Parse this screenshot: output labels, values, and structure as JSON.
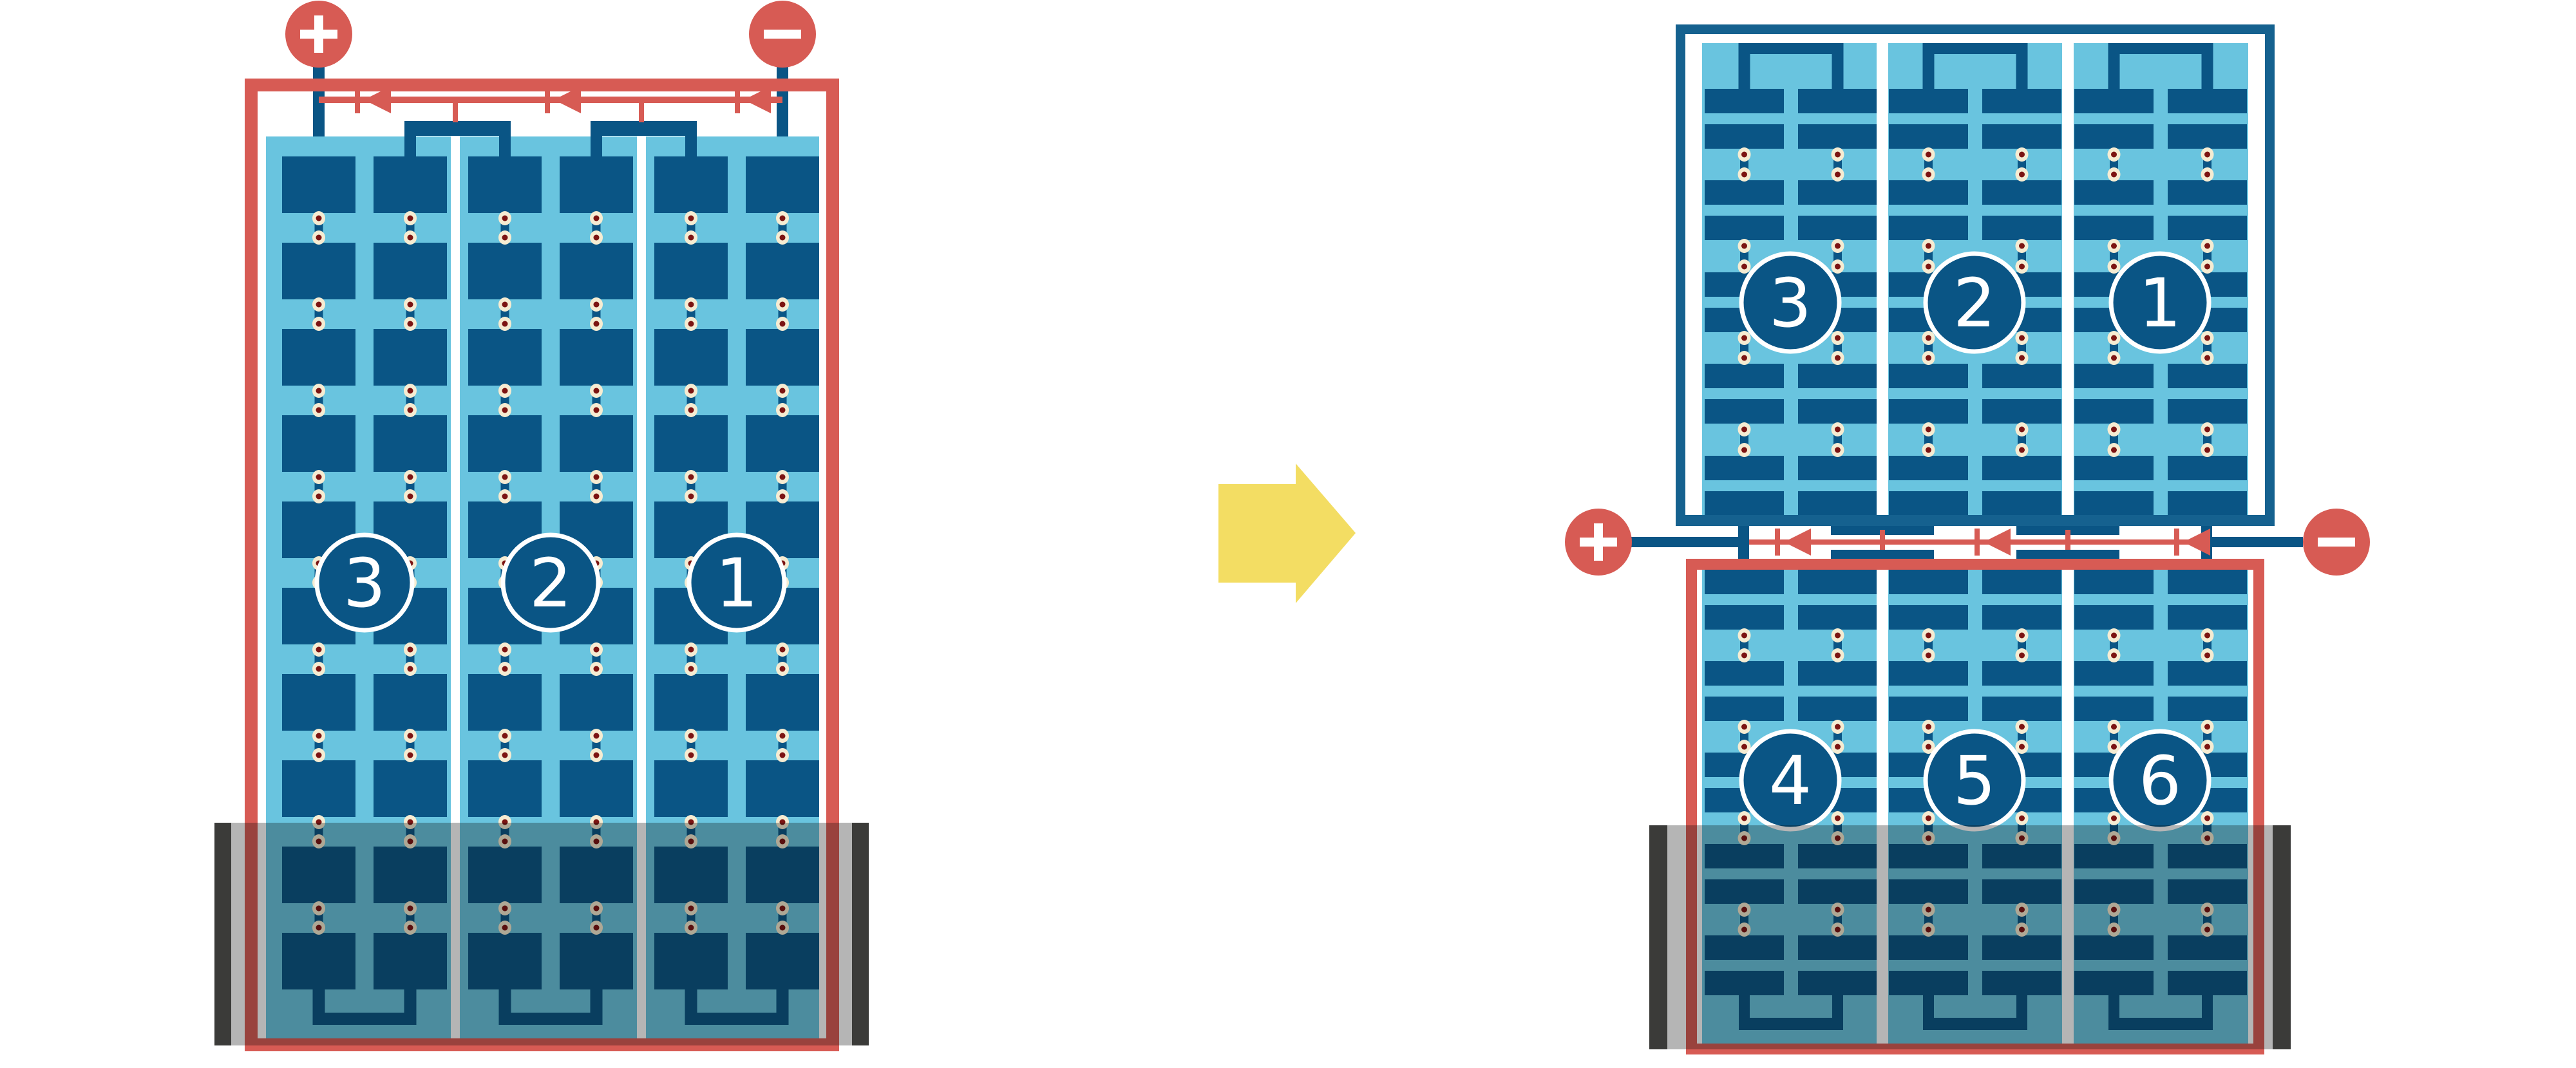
{
  "colors": {
    "red": "#d75b54",
    "module_blue": "#0a5585",
    "frame_blue": "#15618f",
    "panel_light_blue": "#69c4df",
    "cream": "#f6ecd2",
    "dot_core_red": "#7c1412",
    "shade_bar_black": "#3b3b39",
    "shade_overlay": "rgba(10,10,10,0.30)",
    "arrow_yellow": "#f3dd63",
    "badge_text": "#ffffff",
    "background": "#ffffff"
  },
  "left_module": {
    "frame_color": "red",
    "terminals": [
      {
        "symbol": "+"
      },
      {
        "symbol": "-"
      }
    ],
    "string_badges": [
      "3",
      "2",
      "1"
    ],
    "cell_strings": 3,
    "columns_per_string": 2,
    "cell_rows": 10,
    "bypass_diodes": 3,
    "shaded_bottom": true
  },
  "transform_arrow": {
    "direction": "right"
  },
  "right_assembly": {
    "top_module": {
      "frame_color": "blue",
      "string_badges": [
        "3",
        "2",
        "1"
      ],
      "cell_strings": 3,
      "columns_per_string": 2,
      "cell_rows": 10,
      "shaded_bottom": false
    },
    "interconnect": {
      "terminals": [
        {
          "symbol": "+"
        },
        {
          "symbol": "-"
        }
      ],
      "bypass_diodes": 3
    },
    "bottom_module": {
      "frame_color": "red",
      "string_badges": [
        "4",
        "5",
        "6"
      ],
      "cell_strings": 3,
      "columns_per_string": 2,
      "cell_rows": 10,
      "shaded_bottom": true
    }
  }
}
